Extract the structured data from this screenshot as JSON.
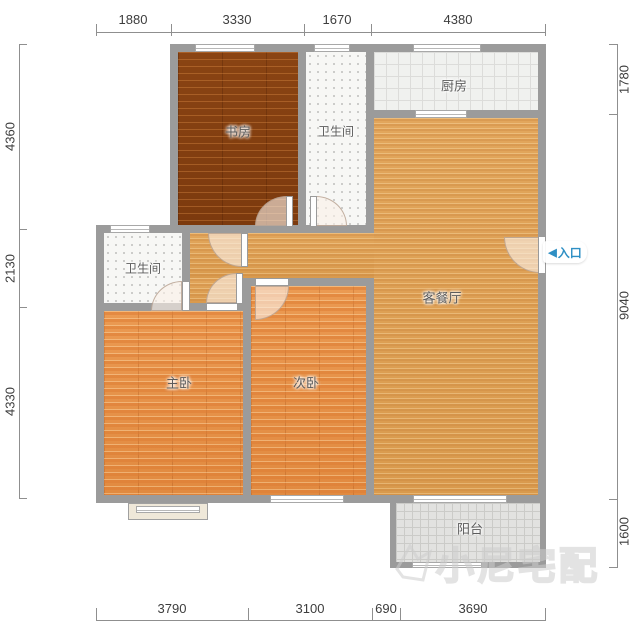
{
  "plan": {
    "rooms": {
      "study": "书房",
      "bath_top": "卫生间",
      "kitchen": "厨房",
      "bath_left": "卫生间",
      "living": "客餐厅",
      "master": "主卧",
      "second": "次卧",
      "balcony": "阳台"
    },
    "entrance": {
      "arrow": "◀",
      "label": "入口",
      "color": "#2e8fc4"
    },
    "dimensions": {
      "top": [
        "1880",
        "3330",
        "1670",
        "4380"
      ],
      "bottom": [
        "3790",
        "3100",
        "690",
        "3690"
      ],
      "left": [
        "4360",
        "2130",
        "4330"
      ],
      "right": [
        "1780",
        "9040",
        "1600"
      ]
    },
    "watermark": {
      "text": "小尼宅配"
    },
    "colors": {
      "wall": "#9b9b9b",
      "study_floor": "#83400f",
      "bedroom_floor": "#e8964f",
      "living_floor": "#dfa257",
      "tile_floor": "#f0f1ef",
      "entrance_accent": "#2e8fc4"
    }
  }
}
